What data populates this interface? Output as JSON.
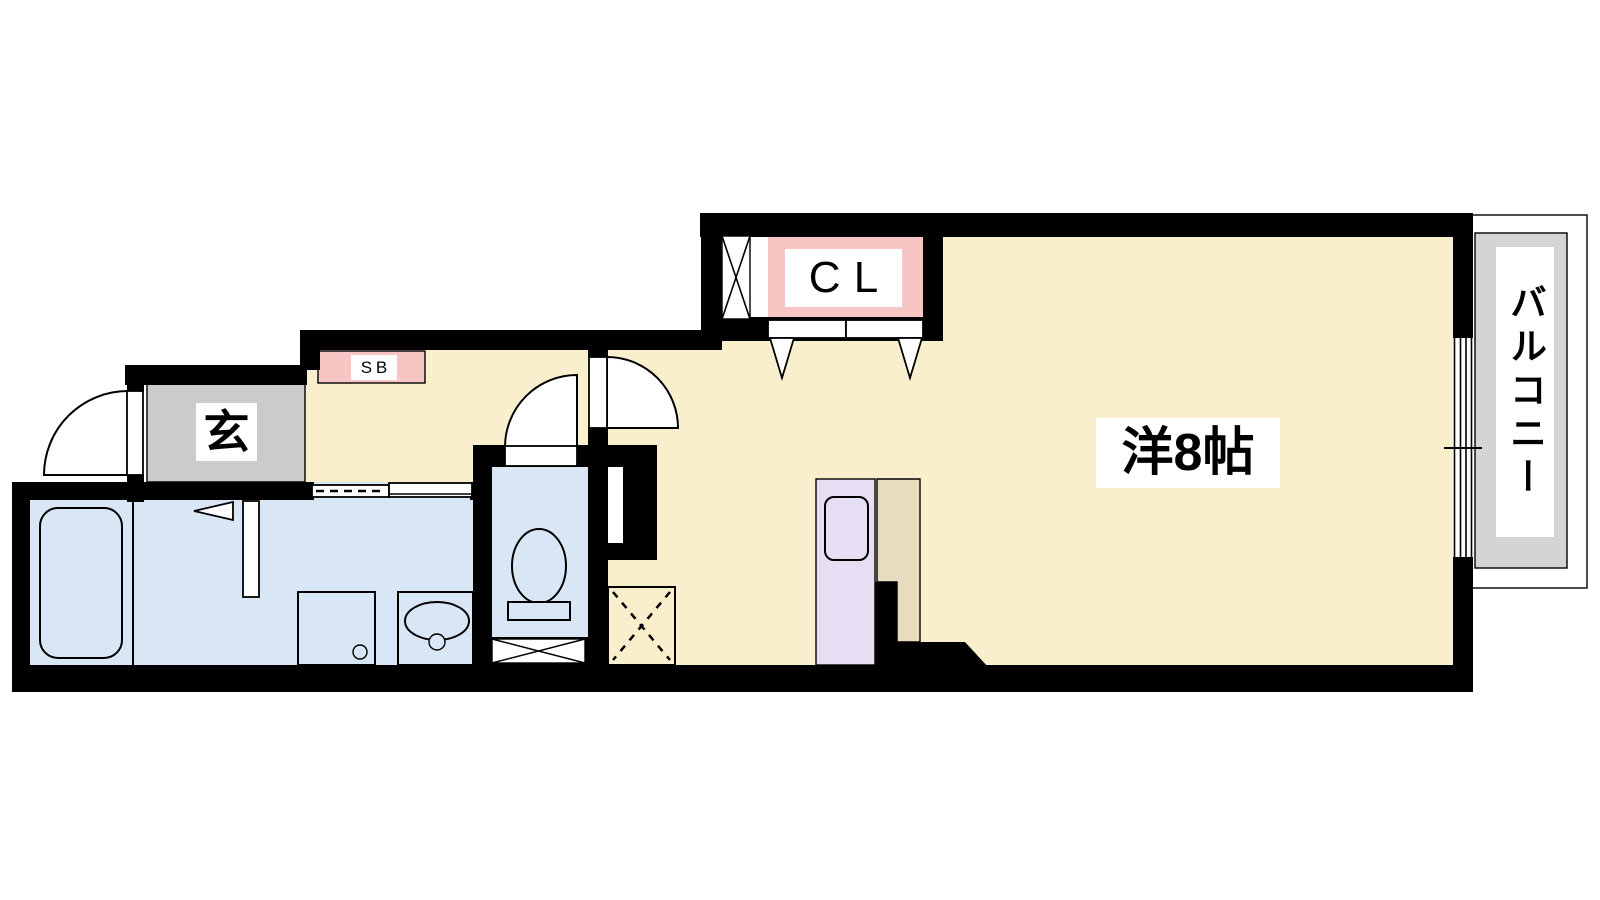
{
  "plan": {
    "type": "apartment-floor-plan",
    "labels": {
      "closet": "CL",
      "shoe_box": "SB",
      "entrance": "玄",
      "main_room": "洋8帖",
      "balcony": "バルコニー"
    },
    "colors": {
      "wall": "#000000",
      "floor_main": "#FAEFCD",
      "floor_wet": "#D9E6F6",
      "floor_entrance": "#CBCBCB",
      "closet_fill": "#F8C5C5",
      "kitchen_fill": "#E6DEF2",
      "counter_fill": "#E8DCBE",
      "balcony_fill": "#D4D4D4",
      "label_bg": "#FFFFFF",
      "line": "#000000"
    }
  }
}
